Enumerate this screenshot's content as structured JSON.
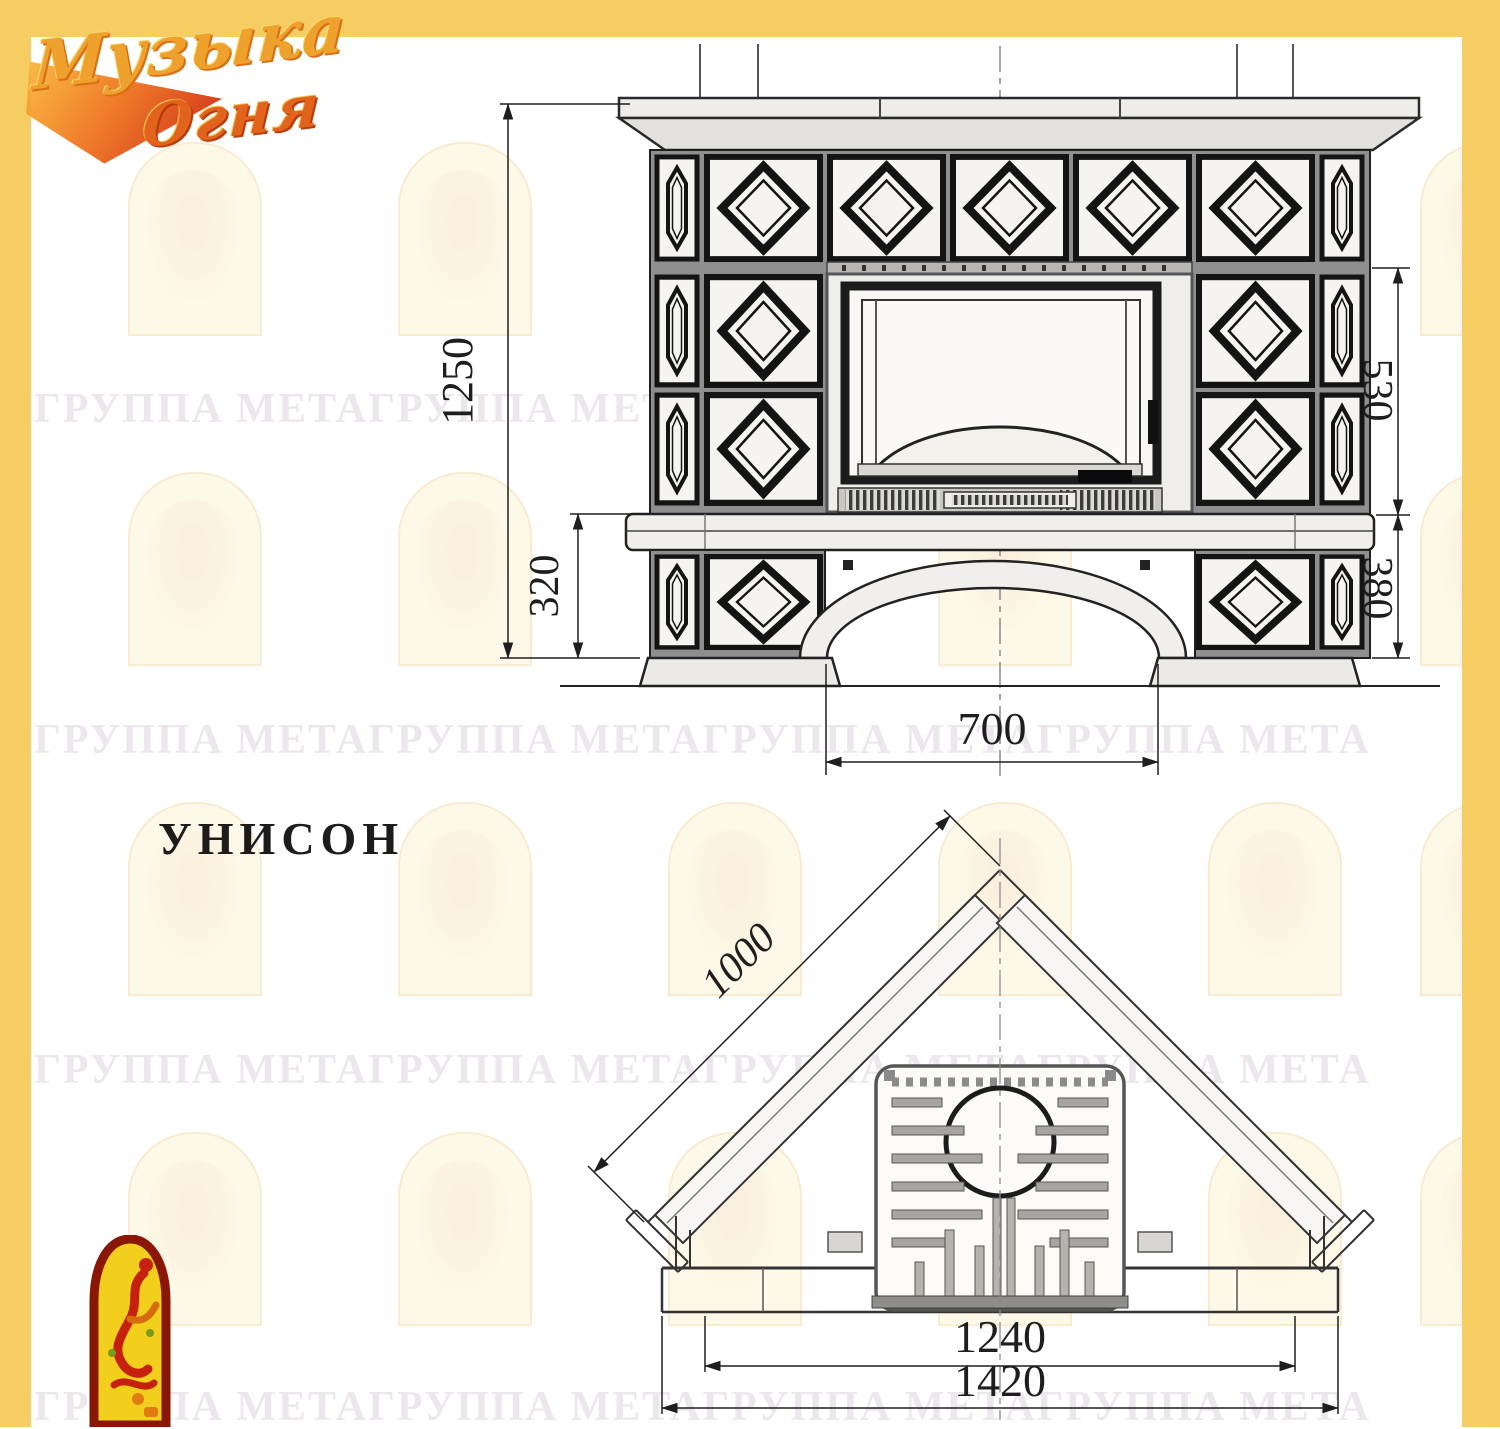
{
  "frame": {
    "color": "#f5cd62"
  },
  "logo": {
    "word1": "Музыка",
    "word2": "Огня"
  },
  "watermark": {
    "row_text": "ГРУППА МЕТАГРУППА МЕТАГРУППА МЕТАГРУППА МЕТА"
  },
  "model": {
    "title": "УНИСОН"
  },
  "front_view": {
    "dims": {
      "total_height": "1250",
      "plinth_height": "320",
      "firebox_height": "530",
      "base_height": "380",
      "arch_width": "700"
    }
  },
  "plan_view": {
    "dims": {
      "flank_depth": "1000",
      "hearth_width": "1240",
      "overall_width": "1420"
    }
  }
}
